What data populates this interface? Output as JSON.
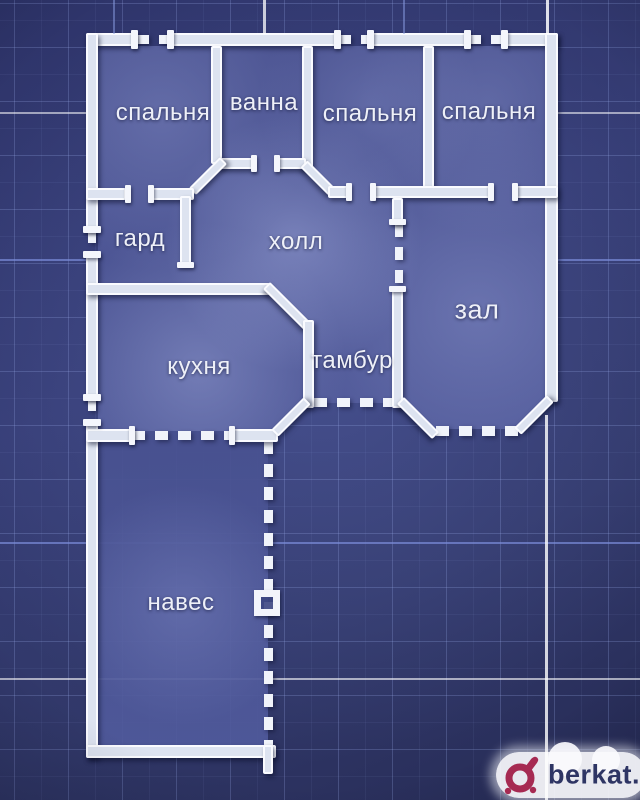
{
  "plan": {
    "title": "floor plan",
    "rooms": [
      {
        "id": "bedroom-1",
        "label": "спальня"
      },
      {
        "id": "bath",
        "label": "ванна"
      },
      {
        "id": "bedroom-2",
        "label": "спальня"
      },
      {
        "id": "bedroom-3",
        "label": "спальня"
      },
      {
        "id": "wardrobe",
        "label": "гард"
      },
      {
        "id": "hall",
        "label": "холл"
      },
      {
        "id": "living-room",
        "label": "зал"
      },
      {
        "id": "kitchen",
        "label": "кухня"
      },
      {
        "id": "vestibule",
        "label": "тамбур"
      },
      {
        "id": "canopy",
        "label": "навес"
      }
    ]
  },
  "watermark": {
    "text": "berkat."
  },
  "colors": {
    "wall": "#f0f3fa",
    "room_fill": "#4b5494",
    "background": "#2c3263",
    "grid_line": "#96a8e6",
    "logo_accent": "#a62a52",
    "logo_text": "#2e3564",
    "label_text": "#eef0f8"
  }
}
